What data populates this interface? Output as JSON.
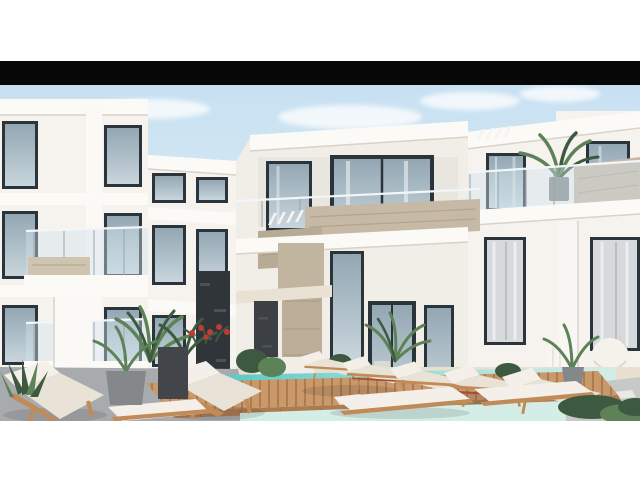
{
  "image": {
    "kind": "architectural-render-photo",
    "letterboxed": true,
    "alt": "Rendering of a modern white residential compound: three-storey apartment blocks with glass balcony railings, marble parapets and a dark stone feature wall, palm plants and red flowers, a timber pool deck with white sun loungers and a turquoise swimming pool"
  },
  "scene": {
    "description": "Modern white apartment complex courtyard with swimming pool, wooden deck, sun loungers, palms and a hanging chair under a clear blue sky",
    "sky": "clear light blue with soft clouds",
    "buildings": 3,
    "sun_loungers": 10,
    "swimming_pool": true,
    "wooden_deck": true,
    "hanging_chair": true,
    "balcony_plants": 2,
    "flowers": "red window-box flowers"
  },
  "palette": {
    "page_bg": "#ffffff",
    "letterbox": "#070707",
    "sky_top": "#c7e0f1",
    "sky_bottom": "#eff7fb",
    "wall_white": "#f6f3ef",
    "wall_warm": "#f1ede7",
    "fascia": "#fbfaf7",
    "edge_shadow": "#d8d2c9",
    "window_frame": "#2c343b",
    "glass_top": "#93a7b3",
    "glass_bottom": "#c8d5dc",
    "curtain": "#d6dadd",
    "railing_glass": "#cfe2ec",
    "railing_post": "#9aa5ad",
    "stone_beige": "#c6b9a5",
    "stone_streak": "#a3937c",
    "stone_dark": "#30353a",
    "beam": "#e9e2d4",
    "patio": "#e8e0cf",
    "walkway": "#a8abae",
    "paver": "#c6c9c5",
    "pool_deep": "#5cc8c6",
    "pool_mid": "#8ed9d3",
    "pool_pale": "#d4eee7",
    "deck_wood": "#c9996b",
    "deck_wood_dark": "#ad7c4e",
    "lounger_cushion": "#f4f0e9",
    "lounger_cushion_shade": "#e8e2d7",
    "lounger_wood": "#c08b58",
    "lounger_red": "#a84b37",
    "plant_green": "#5d8257",
    "plant_dark": "#3d5a41",
    "flower_red": "#c23a31",
    "pot_grey": "#84888b",
    "planter_dark": "#42464a",
    "pot_terracotta": "#c4ab90",
    "shadow": "#1a1a1a"
  }
}
